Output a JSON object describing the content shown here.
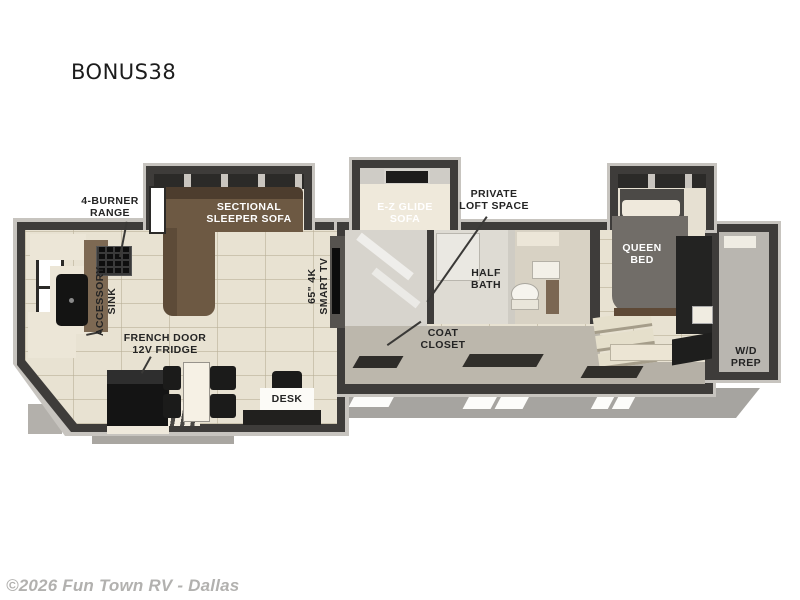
{
  "page": {
    "title": "BONUS38",
    "watermark": "©2026 Fun Town RV - Dallas"
  },
  "labels": {
    "range": {
      "line1": "4-BURNER",
      "line2": "RANGE"
    },
    "sectional": {
      "line1": "SECTIONAL",
      "line2": "SLEEPER SOFA"
    },
    "ez_glide": {
      "line1": "E-Z GLIDE",
      "line2": "SOFA"
    },
    "loft": {
      "line1": "PRIVATE",
      "line2": "LOFT SPACE"
    },
    "queen": {
      "line1": "QUEEN",
      "line2": "BED"
    },
    "sink": {
      "line1": "ACCESSORY",
      "line2": "SINK"
    },
    "tv": {
      "line1": "65\" 4K",
      "line2": "SMART TV"
    },
    "half_bath": {
      "line1": "HALF",
      "line2": "BATH"
    },
    "fridge": {
      "line1": "FRENCH DOOR",
      "line2": "12V FRIDGE"
    },
    "coat": {
      "line1": "COAT",
      "line2": "CLOSET"
    },
    "desk": {
      "line1": "DESK"
    },
    "wd": {
      "line1": "W/D",
      "line2": "PREP"
    }
  },
  "colors": {
    "wall": "#3e3c3a",
    "floor_tile": "#e8e2d2",
    "sofa_brown": "#6d5943",
    "bed_gray": "#716d68",
    "appliance_black": "#161616",
    "chassis_gray": "#a6a4a0",
    "label_text": "#242424",
    "background": "#ffffff"
  }
}
